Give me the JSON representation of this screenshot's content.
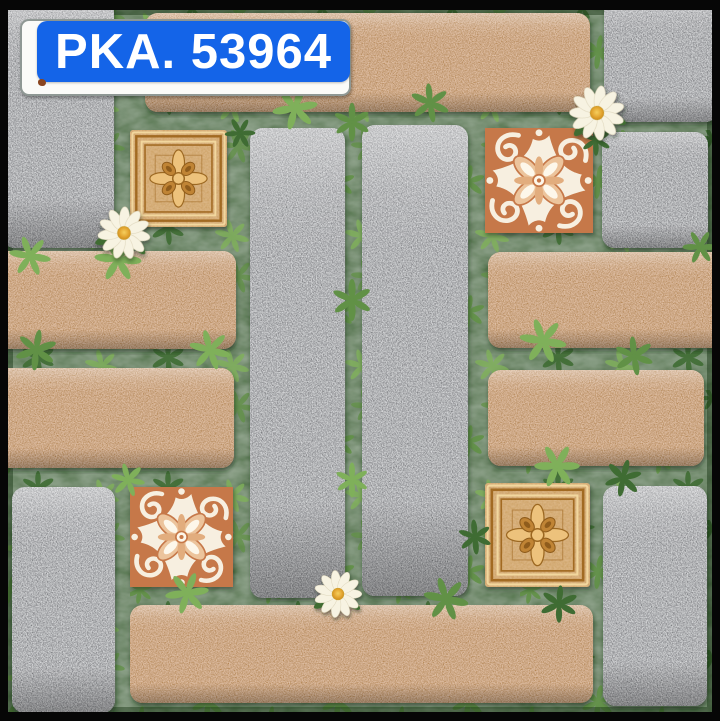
{
  "product_label": {
    "text": "PKA. 53964"
  },
  "colors": {
    "label_blue": "#1464e8",
    "label_text": "#ffffff",
    "label_card": "#fbfbf8",
    "frame_black": "#060606",
    "grass_green": "#4a7939",
    "leaf_light": "#7fb05a",
    "leaf_mid": "#619146",
    "leaf_dark": "#3f6c33",
    "granite_gray": "#a6abb1",
    "brick_orange": "#d6953f",
    "wood_tan": "#dcaa5e",
    "wood_line_light": "#f2d79e",
    "wood_line_dark": "#a26b24",
    "ceramic_cream": "#f7efe0",
    "ceramic_terracotta": "#c67848",
    "ceramic_peach": "#ecc49c",
    "daisy_petal": "#f7f3e2",
    "daisy_center": "#e2a42f"
  },
  "decor": {
    "daisy_count": 3,
    "carved_wood_inset_count": 2,
    "ceramic_ornament_inset_count": 2,
    "elements": [
      "granite-paver",
      "brick-paver",
      "carved-wood-inset",
      "ceramic-ornament-inset",
      "grass-joint",
      "daisy-flower"
    ]
  }
}
